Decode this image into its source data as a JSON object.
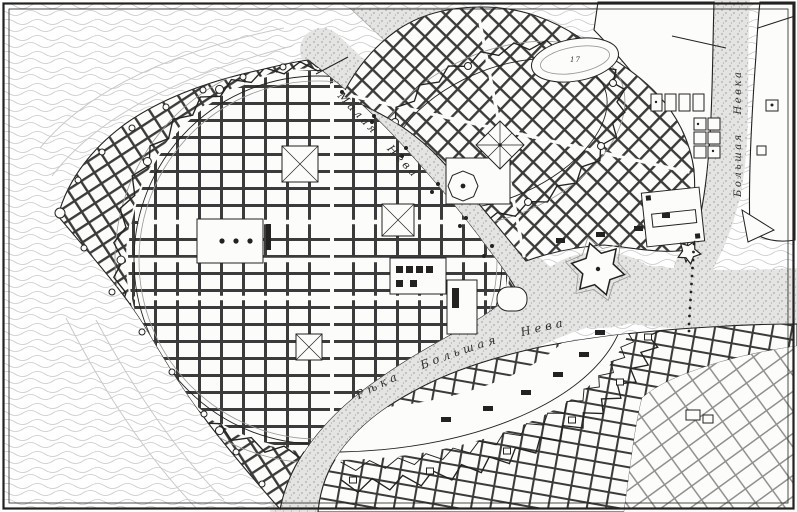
{
  "map": {
    "kind": "engraved-city-plan",
    "description": "Historical engraved plan of the fortified city on the Neva delta islands",
    "labels": {
      "river_malaya_neva": "Малая Нева",
      "river_bolshaya_neva": "Рѣка Большая Нева",
      "river_bolshaya_nevka": "Большая Невка",
      "block_number": "17"
    },
    "colors": {
      "ink": "#232220",
      "paper": "#fcfcfa",
      "sea_line": "#c9c9c9",
      "river_fill": "#e4e4e2",
      "river_dot": "#a9a9a9",
      "block_ink": "#3b3b3b"
    }
  }
}
